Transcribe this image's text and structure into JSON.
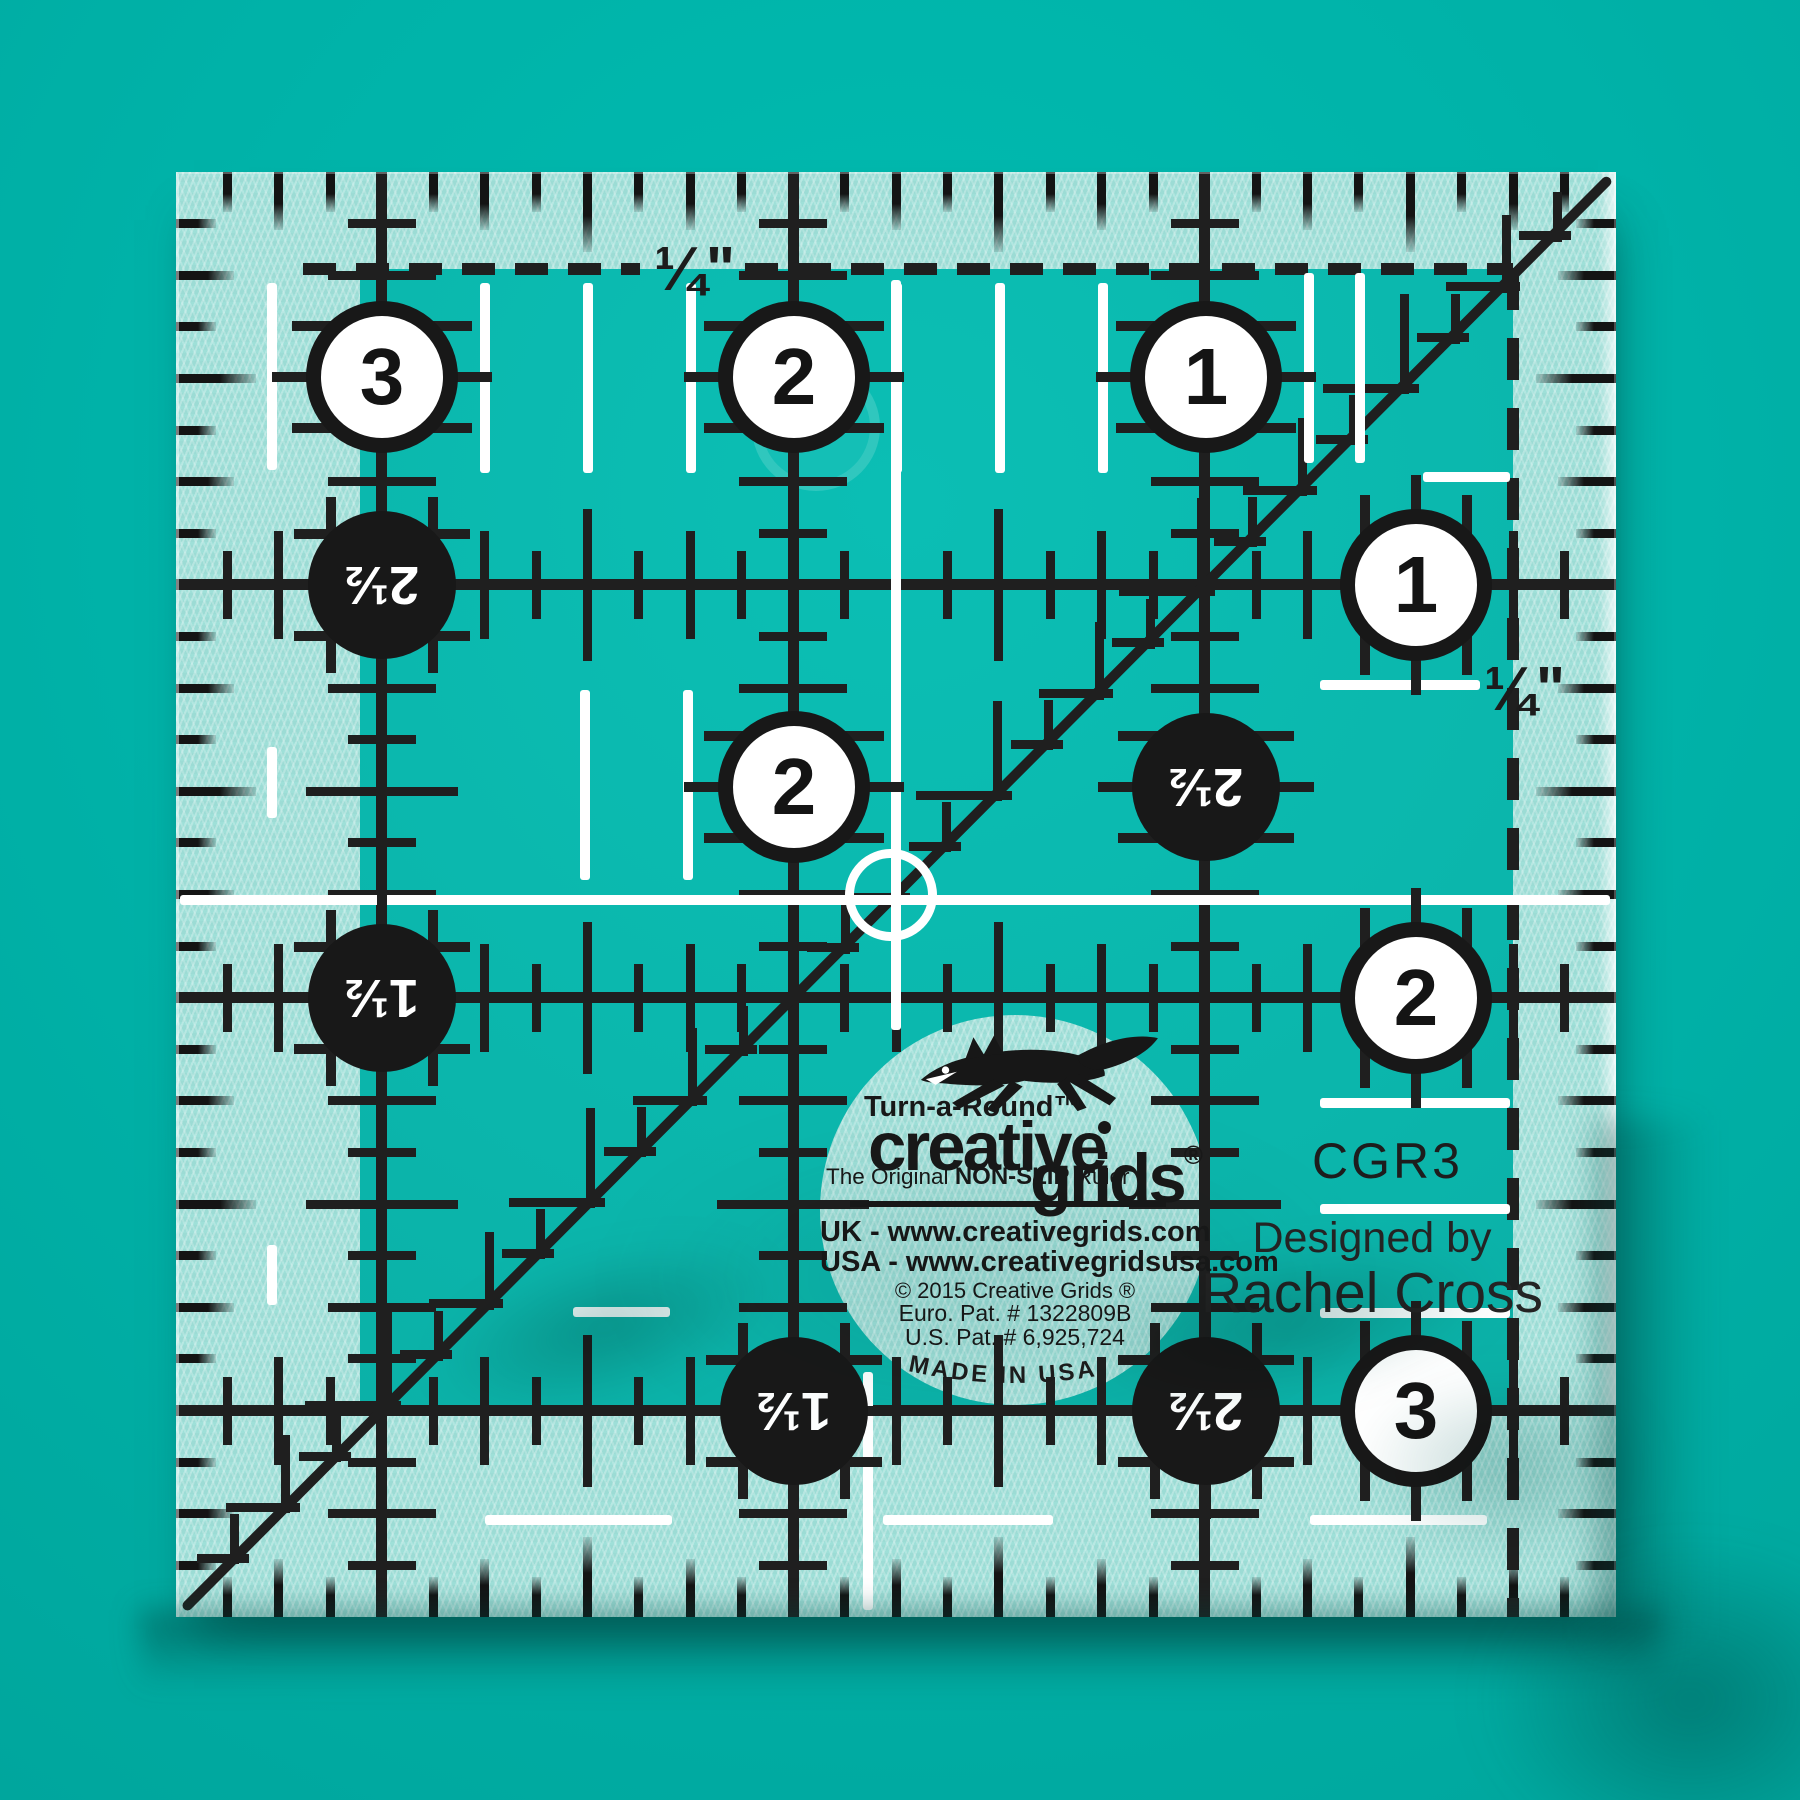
{
  "scene": {
    "background_color": "#00b3a9",
    "ink_color": "#1f1f1f",
    "frost_color": "#9cdcd5",
    "mark_color": "#ffffff"
  },
  "ruler": {
    "model_number": "CGR3",
    "designed_by_label": "Designed by",
    "designer_name": "Rachel Cross",
    "quarter_inch_top": "¼\"",
    "quarter_inch_right": "¼\"",
    "white_circles": [
      {
        "label": "3",
        "x": 206,
        "y": 205,
        "on": "v"
      },
      {
        "label": "2",
        "x": 618,
        "y": 205,
        "on": "v"
      },
      {
        "label": "1",
        "x": 1030,
        "y": 205,
        "on": "v"
      },
      {
        "label": "1",
        "x": 1240,
        "y": 413,
        "on": "h"
      },
      {
        "label": "2",
        "x": 618,
        "y": 615,
        "on": "v"
      },
      {
        "label": "2",
        "x": 1240,
        "y": 826,
        "on": "h"
      },
      {
        "label": "3",
        "x": 1240,
        "y": 1239,
        "on": "h"
      }
    ],
    "black_circles": [
      {
        "label": "2½",
        "x": 206,
        "y": 413,
        "on": "vh"
      },
      {
        "label": "2½",
        "x": 1030,
        "y": 615,
        "on": "v"
      },
      {
        "label": "1½",
        "x": 206,
        "y": 826,
        "on": "vh"
      },
      {
        "label": "1½",
        "x": 618,
        "y": 1239,
        "on": "vh"
      },
      {
        "label": "2½",
        "x": 1030,
        "y": 1239,
        "on": "vh"
      }
    ]
  },
  "logo": {
    "turnaround": "Turn-a-Round™",
    "brand_top": "creative",
    "brand_bottom": "grids",
    "registered": "®",
    "subtitle_pre": "The Original ",
    "subtitle_bold": "NON-SLIP",
    "subtitle_post": " Ruler",
    "uk_url": "UK - www.creativegrids.com",
    "usa_url": "USA - www.creativegridsusa.com",
    "copyright": "© 2015  Creative Grids ®",
    "euro_patent": "Euro. Pat. # 1322809B",
    "us_patent": "U.S. Pat. # 6,925,724",
    "made_in": "MADE IN USA"
  }
}
